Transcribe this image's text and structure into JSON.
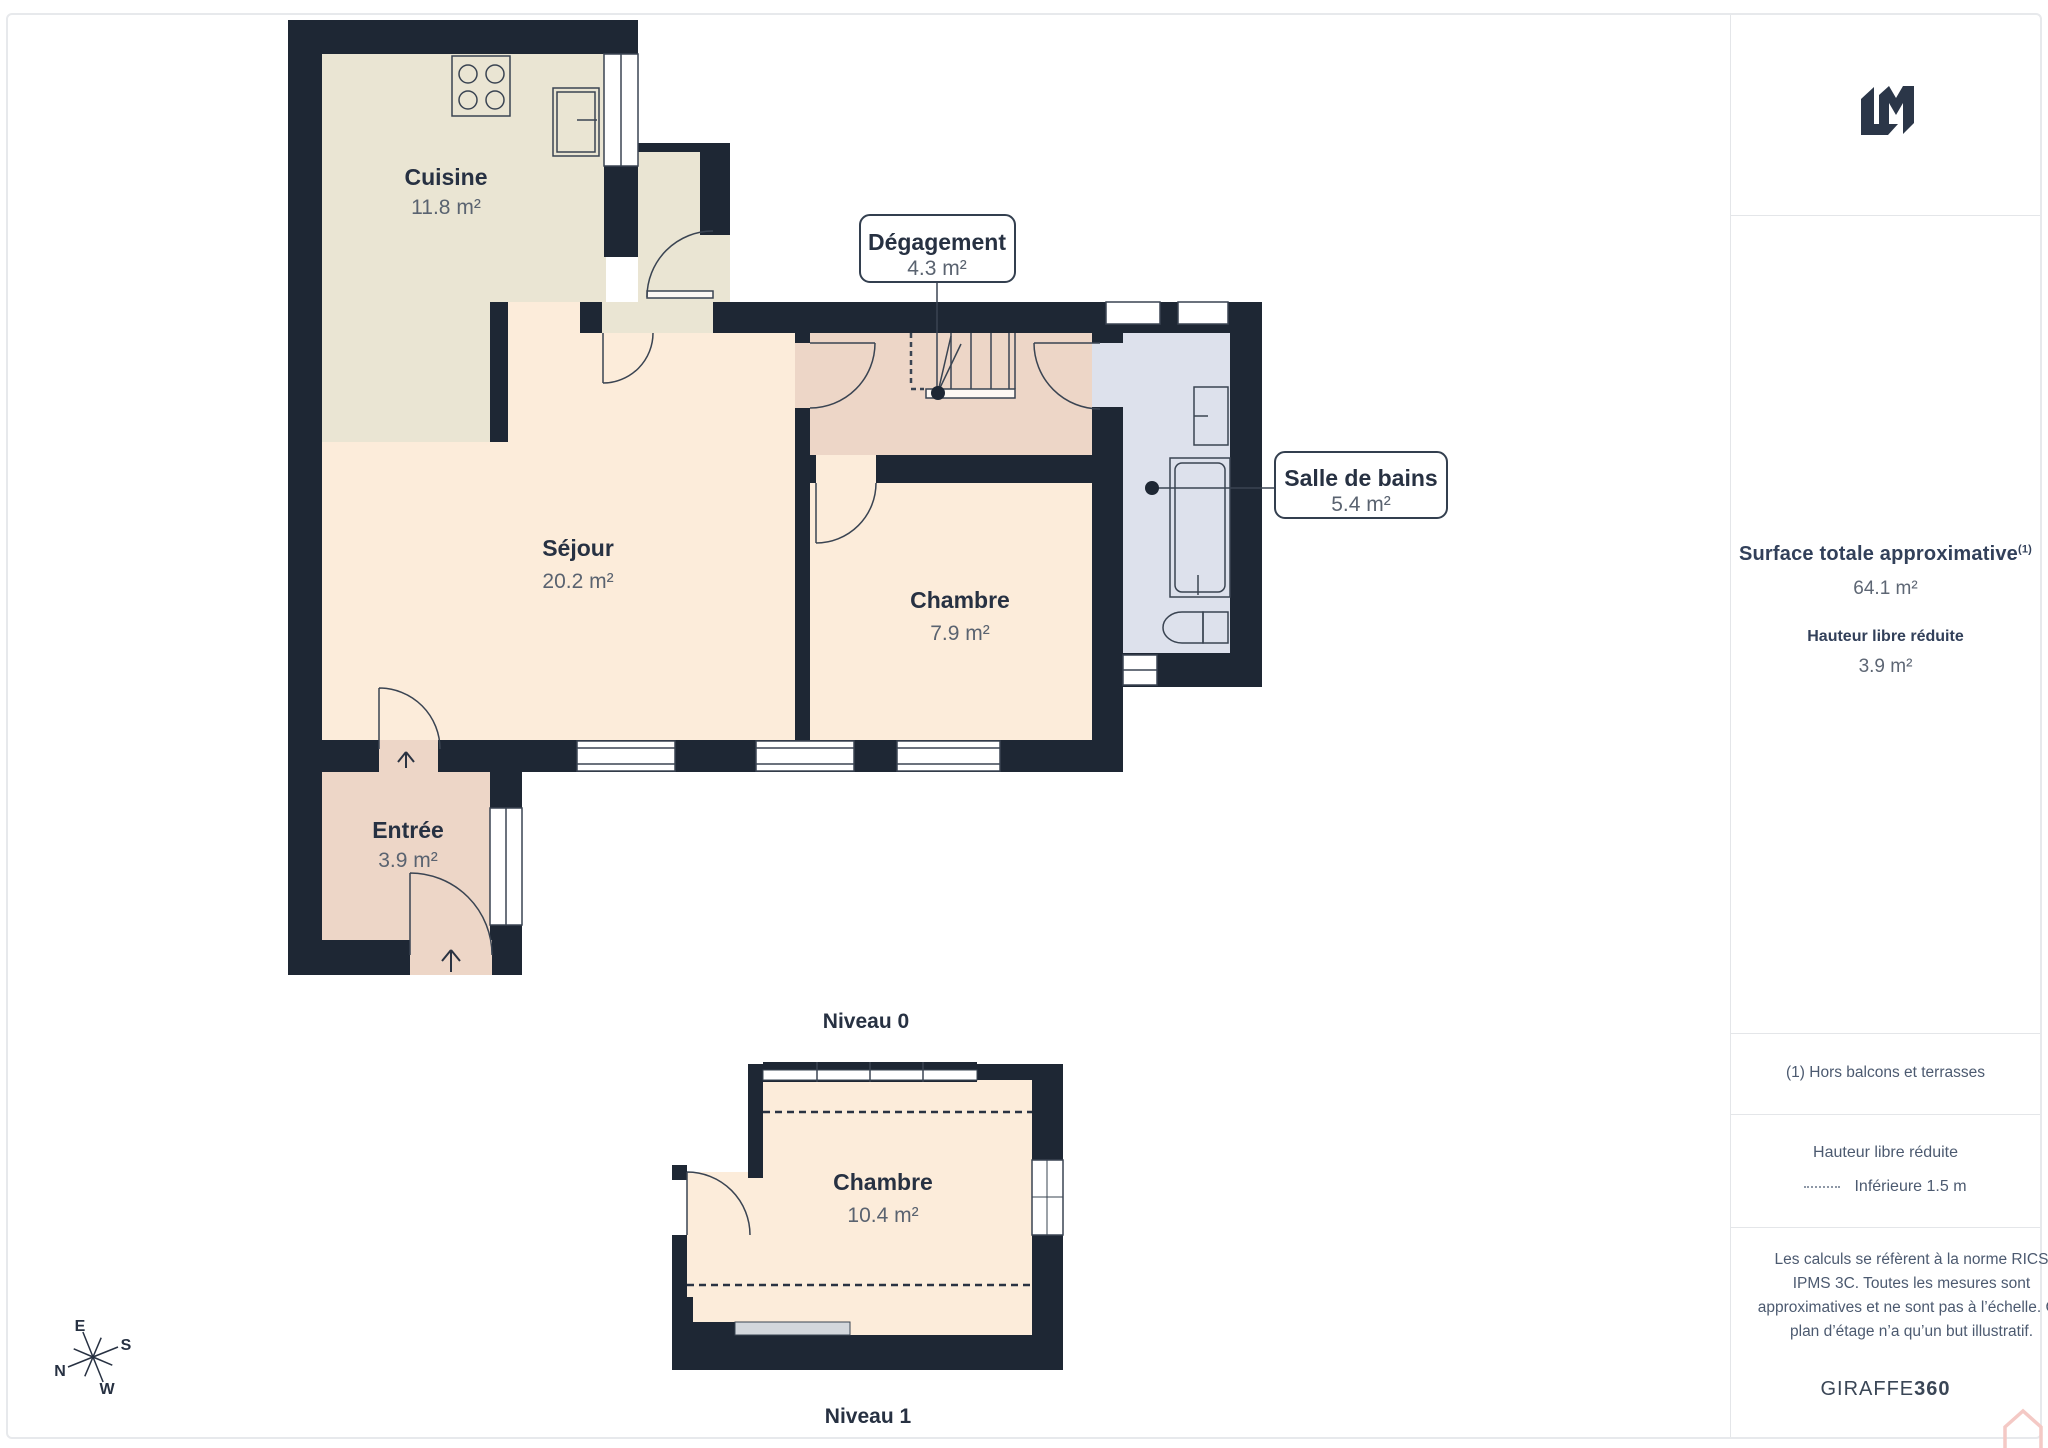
{
  "floorplan": {
    "levels": [
      {
        "name": "Niveau 0",
        "rooms": [
          {
            "name": "Cuisine",
            "area": "11.8 m²"
          },
          {
            "name": "Séjour",
            "area": "20.2 m²"
          },
          {
            "name": "Chambre",
            "area": "7.9 m²"
          },
          {
            "name": "Entrée",
            "area": "3.9 m²"
          },
          {
            "name": "Dégagement",
            "area": "4.3 m²"
          },
          {
            "name": "Salle de bains",
            "area": "5.4 m²"
          }
        ]
      },
      {
        "name": "Niveau 1",
        "rooms": [
          {
            "name": "Chambre",
            "area": "10.4 m²"
          }
        ]
      }
    ],
    "compass": {
      "n": "N",
      "e": "E",
      "s": "S",
      "w": "W"
    },
    "colors": {
      "wall": "#1e2734",
      "kitchen_floor": "#eae5d3",
      "living_floor": "#fcecda",
      "hall_floor": "#edd6c7",
      "bathroom_floor": "#dde1ec",
      "sill_gray": "#d3d7dc",
      "label_dark": "#273142",
      "label_gray": "#5a6370",
      "house_icon_pink": "#f4c9c5"
    }
  },
  "sidebar": {
    "surface_title": "Surface totale approximative",
    "surface_sup": "(1)",
    "surface_value": "64.1 m²",
    "reduced_title": "Hauteur libre réduite",
    "reduced_value": "3.9 m²",
    "footnote": "(1) Hors balcons et terrasses",
    "legend_title": "Hauteur libre réduite",
    "legend_label": "Inférieure 1.5 m",
    "legal": "Les calculs se réfèrent à la norme RICS IPMS 3C. Toutes les mesures sont approximatives et ne sont pas à l’échelle. Ce plan d’étage n’a qu’un but illustratif.",
    "brand": "GIRAFFE",
    "brand_bold": "360"
  }
}
